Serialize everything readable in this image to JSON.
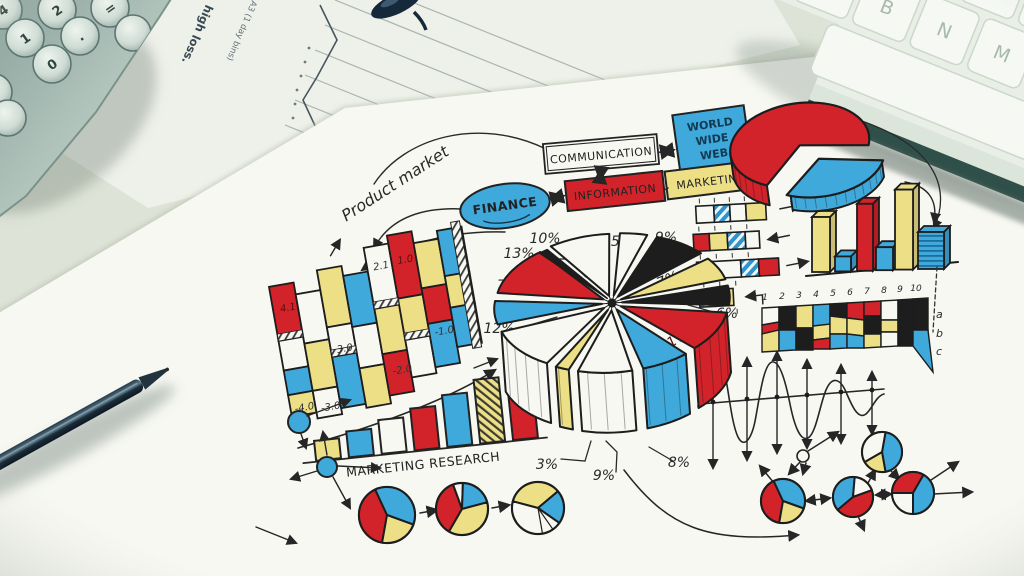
{
  "palette": {
    "red": "#d2232a",
    "blue": "#3fa9dc",
    "yellow": "#ecdf86",
    "black": "#1d1d1d",
    "paper": "#f7f8f2",
    "ink": "#262626"
  },
  "desk": {
    "calculator_keys": [
      "4",
      "2",
      "=",
      "1",
      ".",
      "0"
    ],
    "keyboard_keys": [
      "B",
      "N",
      "M"
    ],
    "printed_note": {
      "line1": "high loss.",
      "line2": "A3 (1 day bins)"
    }
  },
  "flowchart": {
    "product_market": "Product market",
    "communication": "COMMUNICATION",
    "www": [
      "WORLD",
      "WIDE",
      "WEB"
    ],
    "finance": "FINANCE",
    "information": "INFORMATION",
    "marketing": "MARKETING"
  },
  "labels": {
    "marketing_research": "MARKETING  RESEARCH"
  },
  "ribbon_values": {
    "v41": "4.1",
    "v21": "2.1",
    "v10": "1.0",
    "v30": "3.0",
    "m10": "-1.0",
    "m20": "-2.0",
    "m30": "-3.0",
    "m40": "-4.0"
  },
  "right_ribbon": {
    "x_ticks": [
      "1",
      "2",
      "3",
      "4",
      "5",
      "6",
      "7",
      "8",
      "9",
      "10"
    ],
    "side_labels": [
      "a",
      "b",
      "c"
    ]
  },
  "chart_data": [
    {
      "type": "pie",
      "name": "central-exploded-pie",
      "slices": [
        {
          "label": "10%",
          "value": 10,
          "color": "#f7f8f2"
        },
        {
          "label": "5%",
          "value": 5,
          "color": "#f7f8f2"
        },
        {
          "label": "9%",
          "value": 9,
          "color": "#1d1d1d"
        },
        {
          "label": "7%",
          "value": 7,
          "color": "#ecdf86"
        },
        {
          "label": "6%",
          "value": 6,
          "color": "#1d1d1d"
        },
        {
          "label": "11%",
          "value": 11,
          "color": "#d2232a"
        },
        {
          "label": "8%",
          "value": 8,
          "color": "#3fa9dc"
        },
        {
          "label": "9%",
          "value": 9,
          "color": "#f7f8f2"
        },
        {
          "label": "3%",
          "value": 3,
          "color": "#ecdf86"
        },
        {
          "label": "12%",
          "value": 12,
          "color": "#f7f8f2"
        },
        {
          "label": "7%",
          "value": 7,
          "color": "#3fa9dc"
        },
        {
          "label": "13%",
          "value": 13,
          "color": "#d2232a"
        }
      ]
    },
    {
      "type": "pie",
      "name": "top-right-pie",
      "slices": [
        {
          "label": "70%",
          "value": 70,
          "color": "#d2232a"
        },
        {
          "label": "30%",
          "value": 30,
          "color": "#3fa9dc"
        }
      ]
    },
    {
      "type": "bar",
      "name": "marketing-research-bars",
      "values": [
        20,
        26,
        34,
        42,
        52,
        64,
        76
      ],
      "colors": [
        "#ecdf86",
        "#3fa9dc",
        "#f7f8f2",
        "#d2232a",
        "#3fa9dc",
        "hatch-yellow",
        "#d2232a"
      ]
    },
    {
      "type": "bar",
      "name": "right-3d-bars",
      "values": [
        55,
        15,
        67,
        23,
        80,
        37
      ],
      "colors": [
        "#ecdf86",
        "#3fa9dc",
        "#d2232a",
        "#3fa9dc",
        "#ecdf86",
        "blue-lines"
      ]
    },
    {
      "type": "bar",
      "name": "left-3d-ribbon-values",
      "values": [
        4.1,
        2.1,
        1.0,
        3.0,
        -1.0,
        -2.0,
        -3.0,
        -4.0
      ]
    }
  ]
}
